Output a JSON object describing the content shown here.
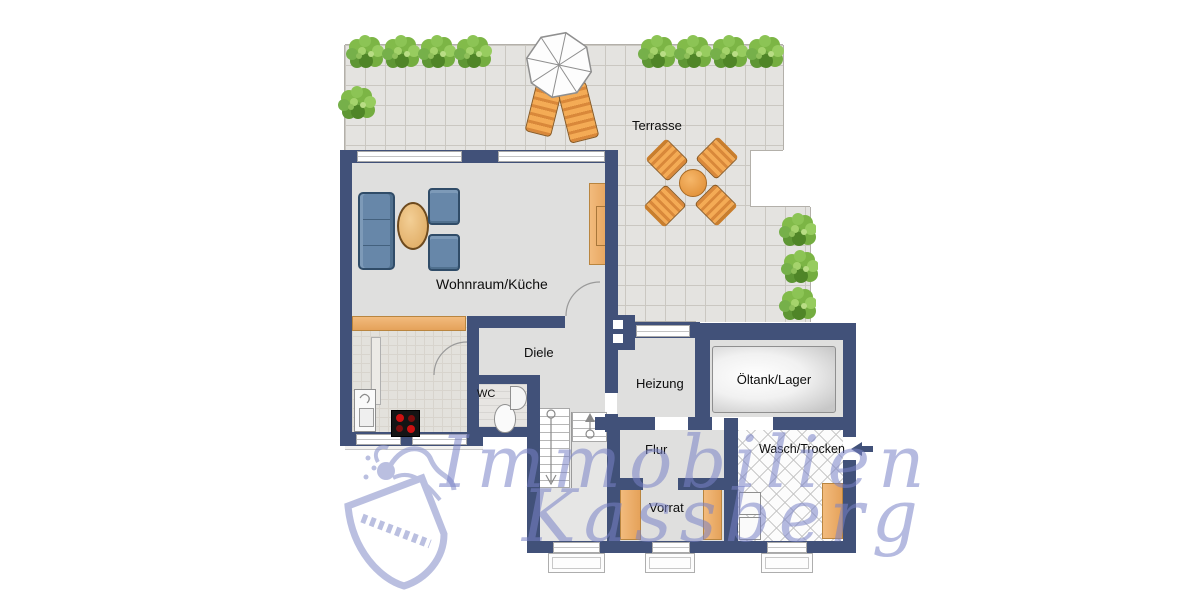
{
  "title": "floor-plan",
  "rooms": {
    "terrasse": "Terrasse",
    "wohnraum": "Wohnraum/Küche",
    "diele": "Diele",
    "wc": "WC",
    "heizung": "Heizung",
    "oeltank": "Öltank/Lager",
    "flur": "Flur",
    "vorrat": "Vorrat",
    "wasch": "Wasch/Trocken"
  },
  "watermark": {
    "line1": "Immobilien",
    "line2": "Kassberg"
  },
  "colors": {
    "wall": "#415179",
    "floor": "#dfdfde",
    "terrace_tile": "#e4e3e0",
    "wood": "#ecae6b",
    "sofa_blue": "#6787a9",
    "terrace_orange": "#f0a04a",
    "plant_green": "#76b043",
    "watermark_blue": "#8d96cc",
    "burner_red": "#cc1111"
  },
  "icons": {
    "entrance_arrow": "left-arrow marking entrance to Wasch/Trocken",
    "crest": "heraldic shield watermark logo"
  }
}
